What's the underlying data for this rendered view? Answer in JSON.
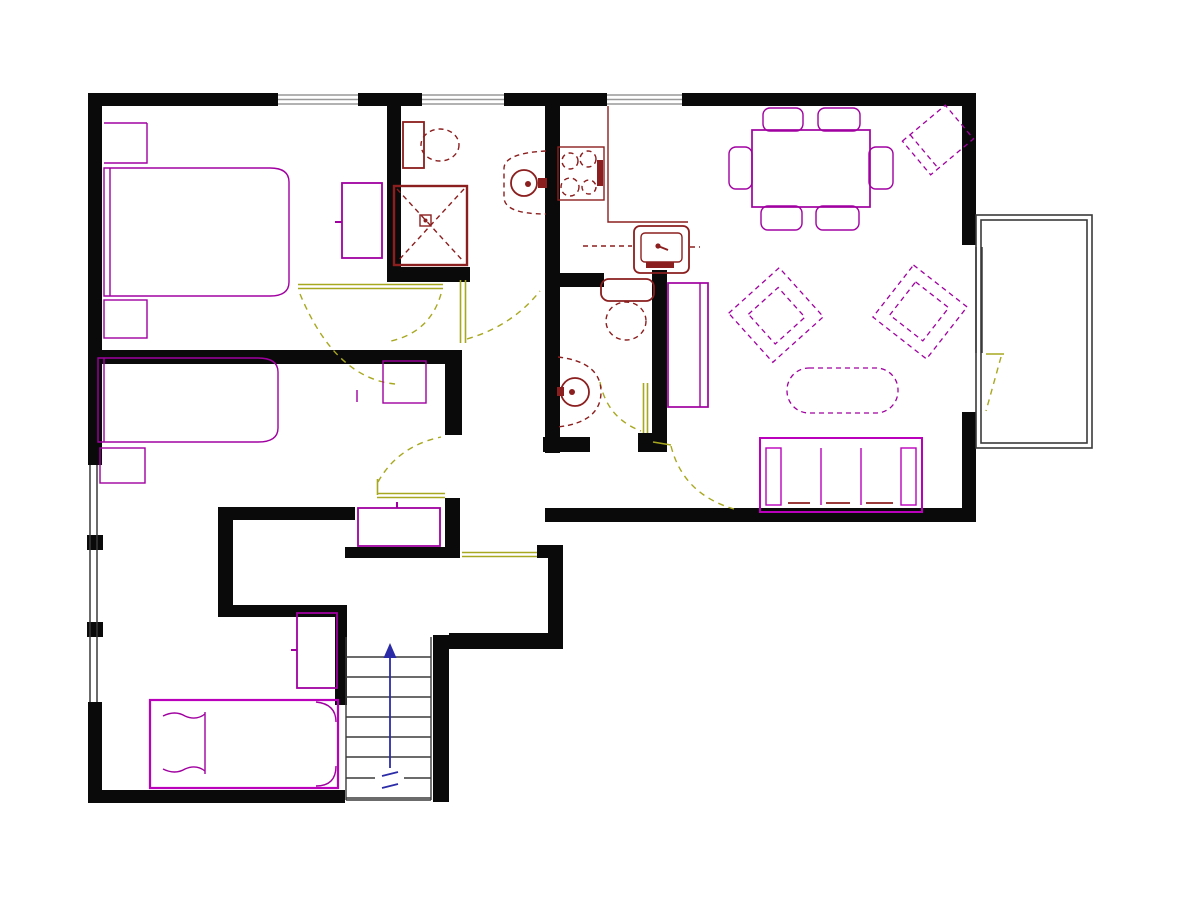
{
  "title": "Apartment floor plan drawing",
  "colors": {
    "wall": "#0a0a0a",
    "furniture": "#a000a0",
    "furniture_accent": "#bb00bb",
    "fixture": "#8b1e1e",
    "door": "#a8a820",
    "stair_arrow": "#2b2ba8",
    "window": "#999999",
    "outline": "#3a3a3a",
    "background": "#ffffff"
  },
  "plan": {
    "stairs": {
      "tread_count": 8,
      "arrow_direction": "up",
      "has_break_symbol": true
    },
    "windows": {
      "top_wall": 3,
      "left_wall": 1,
      "balcony_door_side": 1
    },
    "balcony": {
      "present": true,
      "position": "right"
    },
    "furniture": [
      "double-bed",
      "nightstand",
      "nightstand",
      "dresser",
      "single-bed",
      "nightstand",
      "desk",
      "single-bed",
      "wardrobe",
      "hall-shelf",
      "dining-table",
      "dining-chair",
      "dining-chair",
      "dining-chair",
      "dining-chair",
      "dining-chair",
      "dining-chair",
      "corner-chair",
      "armchair",
      "armchair",
      "coffee-table",
      "sofa",
      "bookcase"
    ],
    "fixtures": [
      "toilet",
      "shower",
      "pedestal-sink",
      "stove",
      "kitchen-counter",
      "kitchen-sink",
      "toilet",
      "pedestal-sink"
    ],
    "doors": 7
  }
}
